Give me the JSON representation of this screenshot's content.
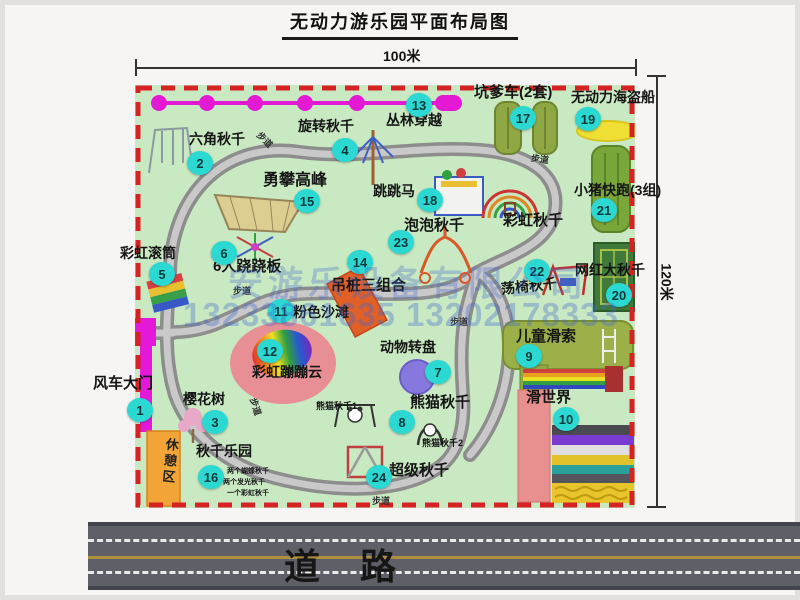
{
  "title": "无动力游乐园平面布局图",
  "dimensions": {
    "top": "100米",
    "right": "120米"
  },
  "road": {
    "label": "道路"
  },
  "watermark": {
    "company": "安游乐设备有限公司",
    "phones": "13233861635 13202178333"
  },
  "walkway_label": "步道",
  "rest_area": {
    "label": "休憩区"
  },
  "attractions": {
    "a1": {
      "num": "1",
      "label": "风车大门"
    },
    "a2": {
      "num": "2",
      "label": "六角秋千"
    },
    "a3": {
      "num": "3",
      "label": "樱花树"
    },
    "a4": {
      "num": "4",
      "label": "旋转秋千"
    },
    "a5": {
      "num": "5",
      "label": "彩虹滚筒"
    },
    "a6": {
      "num": "6",
      "label": "6人跷跷板"
    },
    "a7": {
      "num": "7",
      "label": "动物转盘"
    },
    "a8": {
      "num": "8",
      "label": "熊猫秋千",
      "sub1": "熊猫秋千1",
      "sub2": "熊猫秋千2"
    },
    "a9": {
      "num": "9",
      "label": "儿童滑索"
    },
    "a10": {
      "num": "10",
      "label": "滑世界"
    },
    "a11": {
      "num": "11",
      "label": "粉色沙滩"
    },
    "a12": {
      "num": "12",
      "label": "彩虹蹦蹦云"
    },
    "a13": {
      "num": "13",
      "label": "丛林穿越"
    },
    "a14": {
      "num": "14",
      "label": "吊桩三组合"
    },
    "a15": {
      "num": "15",
      "label": "勇攀高峰"
    },
    "a16": {
      "num": "16",
      "label": "秋千乐园",
      "subs": [
        "两个蝴蝶秋千",
        "两个发光秋千",
        "一个彩虹秋千"
      ]
    },
    "a17": {
      "num": "17",
      "label": "坑爹车(2套)"
    },
    "a18": {
      "num": "18",
      "label": "跳跳马"
    },
    "a19": {
      "num": "19",
      "label": "无动力海盗船"
    },
    "a20": {
      "num": "20",
      "label": "网红大秋千"
    },
    "a21": {
      "num": "21",
      "label": "小猪快跑(3组)"
    },
    "a22": {
      "num": "22",
      "label": "荡椅秋千"
    },
    "a23": {
      "num": "23",
      "label": "泡泡秋千"
    },
    "a24": {
      "num": "24",
      "label": "超级秋千"
    },
    "rainbow_swing": {
      "label": "彩虹秋千"
    }
  },
  "colors": {
    "park_green": "#c9e9c2",
    "border_red": "#d62222",
    "badge_teal": "#2bd8d2",
    "path_gray": "#8d8d8d",
    "gate_magenta": "#e318d8",
    "rest_orange": "#f2a436",
    "road_gray": "#5f5f68"
  }
}
